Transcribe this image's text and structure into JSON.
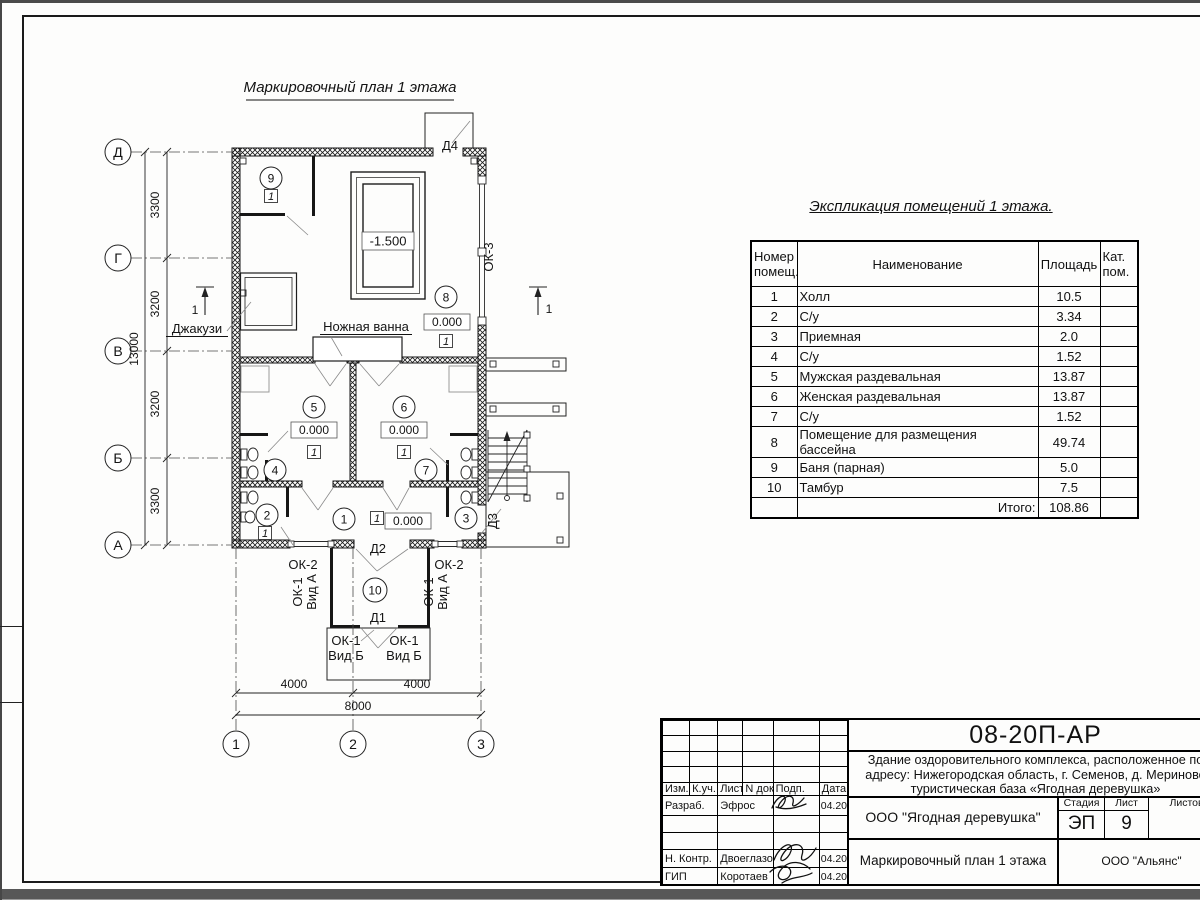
{
  "plan": {
    "title": "Маркировочный план 1 этажа",
    "axis_left": [
      "Д",
      "Г",
      "В",
      "Б",
      "А"
    ],
    "axis_bottom": [
      "1",
      "2",
      "3"
    ],
    "dims_left": [
      "3300",
      "3200",
      "3200",
      "3300"
    ],
    "dim_left_total": "13000",
    "dims_bottom": [
      "4000",
      "4000"
    ],
    "dim_bottom_total": "8000",
    "labels": {
      "jacuzzi": "Джакузи",
      "footbath": "Ножная ванна",
      "d1": "Д1",
      "d2": "Д2",
      "d3": "Д3",
      "d4": "Д4",
      "ok1": "ОК-1",
      "ok2": "ОК-2",
      "ok3": "ОК-3",
      "vid_a": "Вид А",
      "vid_b": "Вид Б"
    },
    "room_numbers": [
      "1",
      "2",
      "3",
      "4",
      "5",
      "6",
      "7",
      "8",
      "9",
      "10"
    ],
    "elevation_zero": "0.000",
    "elevation_pool": "-1.500",
    "marker": "1",
    "section_mark": "1"
  },
  "explication": {
    "title": "Экспликация помещений 1 этажа.",
    "col_num": "Номер помещ.",
    "col_name": "Наименование",
    "col_area": "Площадь",
    "col_cat": "Кат. пом.",
    "rows": [
      {
        "num": "1",
        "name": "Холл",
        "area": "10.5",
        "cat": ""
      },
      {
        "num": "2",
        "name": "С/у",
        "area": "3.34",
        "cat": ""
      },
      {
        "num": "3",
        "name": "Приемная",
        "area": "2.0",
        "cat": ""
      },
      {
        "num": "4",
        "name": "С/у",
        "area": "1.52",
        "cat": ""
      },
      {
        "num": "5",
        "name": "Мужская раздевальная",
        "area": "13.87",
        "cat": ""
      },
      {
        "num": "6",
        "name": "Женская раздевальная",
        "area": "13.87",
        "cat": ""
      },
      {
        "num": "7",
        "name": "С/у",
        "area": "1.52",
        "cat": ""
      },
      {
        "num": "8",
        "name": "Помещение для размещения бассейна",
        "area": "49.74",
        "cat": ""
      },
      {
        "num": "9",
        "name": "Баня (парная)",
        "area": "5.0",
        "cat": ""
      },
      {
        "num": "10",
        "name": "Тамбур",
        "area": "7.5",
        "cat": ""
      }
    ],
    "total_label": "Итого:",
    "total_value": "108.86"
  },
  "titleblock": {
    "doc_number": "08-20П-АР",
    "project_line1": "Здание оздоровительного комплекса, расположенное по",
    "project_line2": "адресу: Нижегородская область, г. Семенов, д. Мериново",
    "project_line3": "туристическая база «Ягодная деревушка»",
    "org": "ООО \"Ягодная деревушка\"",
    "stage_label": "Стадия",
    "sheet_label": "Лист",
    "sheets_label": "Листов",
    "stage_value": "ЭП",
    "sheet_value": "9",
    "sheets_value": "",
    "sheet_title": "Маркировочный план 1 этажа",
    "contractor": "ООО \"Альянс\"",
    "cols": [
      "Изм.",
      "К.уч.",
      "Лист",
      "N док.",
      "Подп.",
      "Дата"
    ],
    "rows": [
      {
        "role": "Разраб.",
        "name": "Эфрос",
        "date": "04.20"
      },
      {
        "role": "",
        "name": "",
        "date": ""
      },
      {
        "role": "",
        "name": "",
        "date": ""
      },
      {
        "role": "Н. Контр.",
        "name": "Двоеглазов",
        "date": "04.20"
      },
      {
        "role": "ГИП",
        "name": "Коротаев",
        "date": "04.20"
      }
    ]
  }
}
